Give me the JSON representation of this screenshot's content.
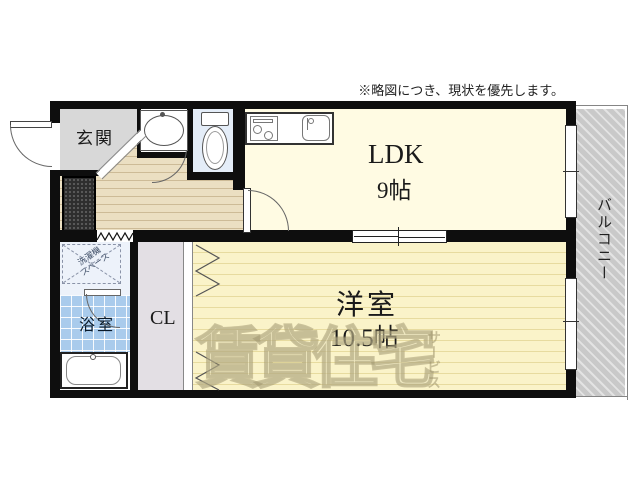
{
  "note": {
    "text": "※略図につき、現状を優先します。"
  },
  "rooms": {
    "genkan": {
      "label": "玄関"
    },
    "ldk": {
      "label": "LDK",
      "size": "9帖"
    },
    "western": {
      "label": "洋室",
      "size": "10.5帖"
    },
    "closet": {
      "label": "CL"
    },
    "bathroom": {
      "label": "浴室"
    },
    "balcony": {
      "label": "バルコニー"
    },
    "laundry": {
      "line1": "洗濯機",
      "line2": "スペース"
    }
  },
  "watermark": {
    "main": "賃貸住宅",
    "sub": "サービス"
  },
  "colors": {
    "wall": "#0e0e0e",
    "ldk_floor": "#fffbe3",
    "western_floor": "#faf3c9",
    "hall_floor": "#ebdfc2",
    "genkan_floor": "#d8d8d8",
    "bath_floor": "#a9cbec",
    "toilet_floor": "#e4edf8",
    "closet_floor": "#e3dfe4",
    "balcony_floor": "#c9c9c9",
    "watermark": "#9e946c"
  }
}
